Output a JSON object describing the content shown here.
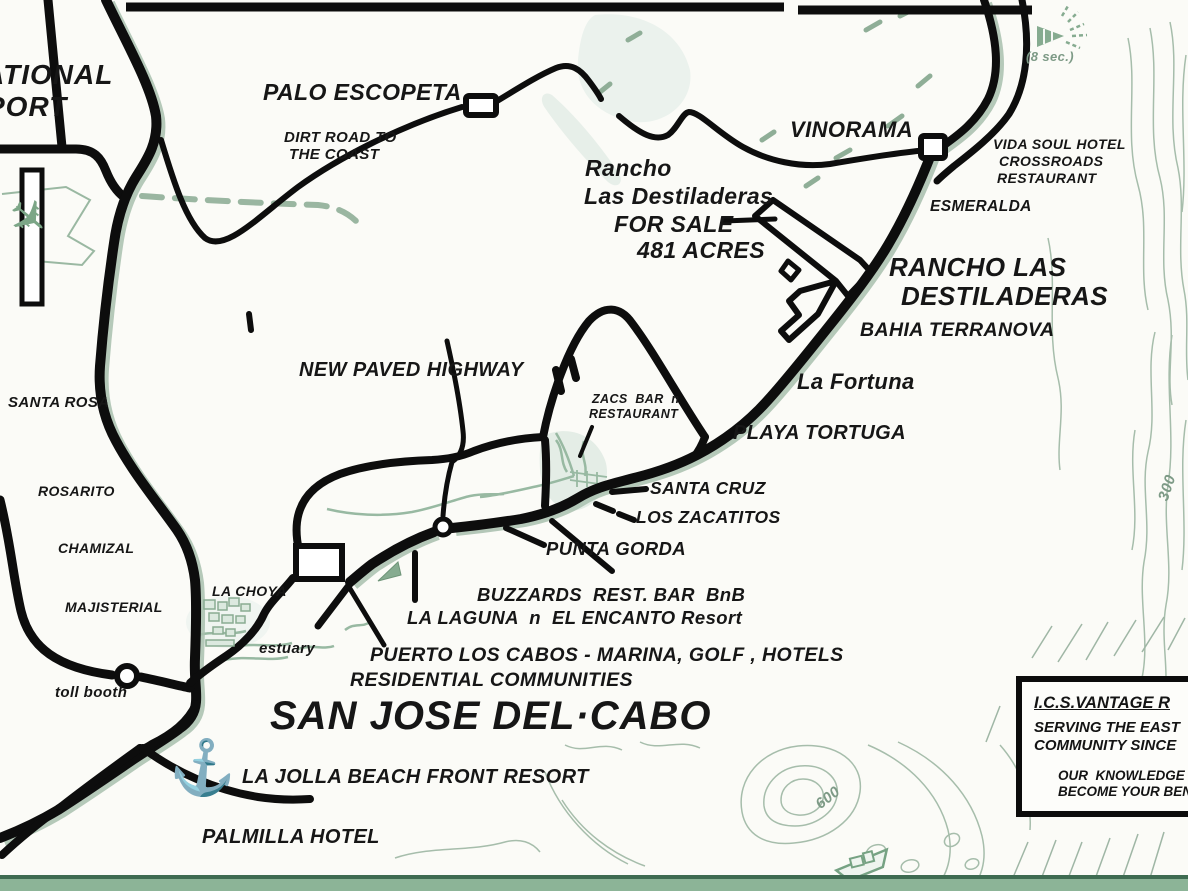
{
  "map_title": "SAN JOSE DEL CABO area real estate map",
  "labels": {
    "airport_line1": "ATIONAL",
    "airport_line2": "PORT",
    "palo_escopeta": "PALO ESCOPETA",
    "dirt_road_line1": "DIRT ROAD TO",
    "dirt_road_line2": "THE COAST",
    "vinorama": "VINORAMA",
    "vida_soul_line1": "VIDA SOUL HOTEL",
    "vida_soul_line2": "CROSSROADS",
    "vida_soul_line3": "RESTAURANT",
    "eight_sec": "(8 sec.)",
    "esmeralda": "ESMERALDA",
    "rancho_sale_line1": "Rancho",
    "rancho_sale_line2": "Las Destiladeras",
    "rancho_sale_line3": "FOR SALE",
    "rancho_sale_line4": "481 ACRES",
    "rancho_big_line1": "RANCHO LAS",
    "rancho_big_line2": "DESTILADERAS",
    "bahia_terranova": "BAHIA TERRANOVA",
    "la_fortuna": "La Fortuna",
    "playa_tortuga": "PLAYA TORTUGA",
    "new_paved_highway": "NEW PAVED HIGHWAY",
    "zacs_line1": "ZACS  BAR  n",
    "zacs_line2": "RESTAURANT",
    "santa_cruz": "SANTA CRUZ",
    "los_zacatitos": "LOS ZACATITOS",
    "punta_gorda": "PUNTA GORDA",
    "buzzards": "BUZZARDS  REST. BAR  BnB",
    "la_laguna": "LA LAGUNA  n  EL ENCANTO Resort",
    "puerto_los_cabos": "PUERTO LOS CABOS - MARINA, GOLF , HOTELS",
    "residential": "RESIDENTIAL COMMUNITIES",
    "san_jose": "SAN JOSE DEL·CABO",
    "la_jolla": "LA JOLLA BEACH FRONT RESORT",
    "palmilla": "PALMILLA HOTEL",
    "santa_rosa": "SANTA ROSA",
    "rosarito": "ROSARITO",
    "chamizal": "CHAMIZAL",
    "majisterial": "MAJISTERIAL",
    "la_choya": "LA CHOYA",
    "estuary": "estuary",
    "toll_booth": "toll booth",
    "contour_300": "300",
    "contour_600": "600"
  },
  "info_box": {
    "line1": "I.C.S.VANTAGE R",
    "line2": "SERVING THE EAST",
    "line3": "COMMUNITY SINCE",
    "line4": "OUR  KNOWLEDGE",
    "line5": "BECOME YOUR BEN"
  },
  "icons": {
    "airplane_glyph": "✈",
    "anchor_glyph": "⚓"
  },
  "colors": {
    "road_black": "#0d0d0d",
    "map_green": "#8fae97",
    "contour_green": "#a6bdab",
    "band_green": "#8cb497"
  }
}
